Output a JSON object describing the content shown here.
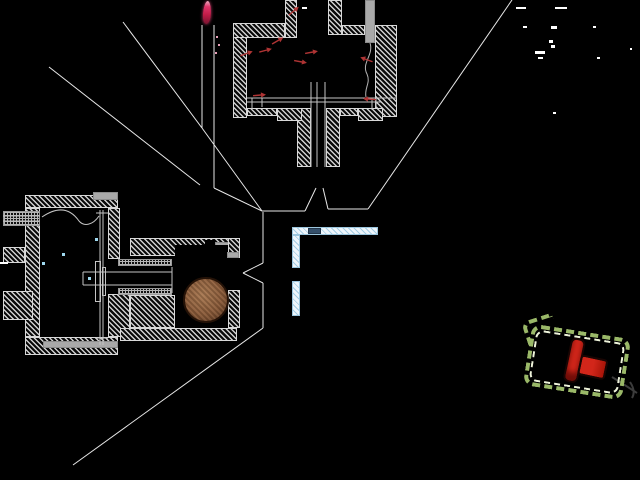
{
  "canvas": {
    "width": 640,
    "height": 480,
    "background": "#000000"
  },
  "palette": {
    "hatch_line": "#cfcfcf",
    "block_outline": "#d8d8d8",
    "gray_fill": "#a9a9a9",
    "knurl_dot": "#b5b5b5",
    "cyan_fill": "#eef6fc",
    "cyan_hatch": "#a5cde4",
    "dark_blue_block": "#35506b",
    "leader_line": "#e8e8e8",
    "detail_line": "#c4c4c4",
    "wire_line": "#b4b4b4",
    "hook_line": "#3c3c3c",
    "red_arrow": "#b03434",
    "flame_core": "#c21c48",
    "flame_glow": "#e87a9a",
    "ball_brown": "#8a5a38",
    "plug_red": "#d2261a",
    "plug_dark_red": "#a81408",
    "dash_outer_green": "#9ab868",
    "dash_inner_cream": "#eef3da",
    "speck_white": "#ffffff",
    "droplet_cyan": "#9fd8ef"
  },
  "blocks": [
    {
      "name": "chamber-left-wall",
      "style": "hatch",
      "x": 233,
      "y": 23,
      "w": 14,
      "h": 95
    },
    {
      "name": "chamber-top-wall-left",
      "style": "hatch",
      "x": 233,
      "y": 23,
      "w": 52,
      "h": 15
    },
    {
      "name": "chamber-chimney-left",
      "style": "hatch",
      "x": 285,
      "y": 0,
      "w": 12,
      "h": 38
    },
    {
      "name": "chamber-chimney-right",
      "style": "hatch",
      "x": 328,
      "y": 0,
      "w": 14,
      "h": 35
    },
    {
      "name": "chamber-top-wall-mid",
      "style": "hatch",
      "x": 342,
      "y": 25,
      "w": 23,
      "h": 10
    },
    {
      "name": "chamber-right-wall",
      "style": "hatch",
      "x": 375,
      "y": 25,
      "w": 22,
      "h": 92
    },
    {
      "name": "chamber-probe-tube",
      "style": "gray",
      "x": 365,
      "y": 0,
      "w": 10,
      "h": 43
    },
    {
      "name": "nozzle-wall-left",
      "style": "hatch",
      "x": 297,
      "y": 108,
      "w": 14,
      "h": 59
    },
    {
      "name": "nozzle-wall-right",
      "style": "hatch",
      "x": 326,
      "y": 108,
      "w": 14,
      "h": 59
    },
    {
      "name": "chamber-floor-left-a",
      "style": "hatch",
      "x": 247,
      "y": 108,
      "w": 30,
      "h": 8
    },
    {
      "name": "chamber-floor-left-b",
      "style": "hatch",
      "x": 277,
      "y": 108,
      "w": 25,
      "h": 13
    },
    {
      "name": "chamber-floor-right-a",
      "style": "hatch",
      "x": 340,
      "y": 108,
      "w": 18,
      "h": 8
    },
    {
      "name": "chamber-floor-right-b",
      "style": "hatch",
      "x": 358,
      "y": 108,
      "w": 25,
      "h": 13
    },
    {
      "name": "housing-top-wall",
      "style": "hatch",
      "x": 25,
      "y": 195,
      "w": 93,
      "h": 13
    },
    {
      "name": "housing-top-cap",
      "style": "gray",
      "x": 93,
      "y": 192,
      "w": 25,
      "h": 8
    },
    {
      "name": "housing-left-wall",
      "style": "hatch",
      "x": 25,
      "y": 208,
      "w": 15,
      "h": 129
    },
    {
      "name": "inlet-fitting",
      "style": "knurl",
      "x": 3,
      "y": 211,
      "w": 37,
      "h": 15
    },
    {
      "name": "left-flange",
      "style": "hatch",
      "x": 3,
      "y": 247,
      "w": 22,
      "h": 16
    },
    {
      "name": "lower-left-block",
      "style": "hatch",
      "x": 3,
      "y": 291,
      "w": 30,
      "h": 29
    },
    {
      "name": "housing-bottom-wall",
      "style": "hatch",
      "x": 25,
      "y": 337,
      "w": 93,
      "h": 18
    },
    {
      "name": "housing-bottom-strip",
      "style": "gray",
      "x": 43,
      "y": 341,
      "w": 75,
      "h": 7
    },
    {
      "name": "housing-right-wall-upper",
      "style": "hatch",
      "x": 108,
      "y": 208,
      "w": 12,
      "h": 51
    },
    {
      "name": "housing-mid-wall-lower",
      "style": "hatch",
      "x": 108,
      "y": 294,
      "w": 22,
      "h": 43
    },
    {
      "name": "valve-body-top",
      "style": "hatch",
      "x": 130,
      "y": 238,
      "w": 107,
      "h": 18
    },
    {
      "name": "valve-body-top-notch",
      "style": "cavity",
      "x": 205,
      "y": 240,
      "w": 10,
      "h": 9
    },
    {
      "name": "valve-body-top-cap",
      "style": "gray",
      "x": 215,
      "y": 242,
      "w": 22,
      "h": 7
    },
    {
      "name": "valve-ball-cavity",
      "style": "cavity",
      "x": 175,
      "y": 245,
      "w": 60,
      "h": 83
    },
    {
      "name": "channel-thread-top",
      "style": "knurl",
      "x": 118,
      "y": 259,
      "w": 54,
      "h": 7
    },
    {
      "name": "channel-thread-bottom",
      "style": "knurl",
      "x": 118,
      "y": 288,
      "w": 54,
      "h": 7
    },
    {
      "name": "valve-body-below-channel",
      "style": "hatch",
      "x": 130,
      "y": 295,
      "w": 45,
      "h": 33
    },
    {
      "name": "valve-right-wall-top",
      "style": "hatch",
      "x": 228,
      "y": 238,
      "w": 12,
      "h": 20
    },
    {
      "name": "valve-seat-band",
      "style": "gray",
      "x": 227,
      "y": 252,
      "w": 12,
      "h": 6
    },
    {
      "name": "valve-right-wall-bottom",
      "style": "hatch",
      "x": 228,
      "y": 290,
      "w": 12,
      "h": 38
    },
    {
      "name": "valve-body-bottom-wall",
      "style": "hatch",
      "x": 120,
      "y": 328,
      "w": 117,
      "h": 13
    },
    {
      "name": "stem-plate-large",
      "style": "plate",
      "x": 95,
      "y": 261,
      "w": 6,
      "h": 41
    },
    {
      "name": "stem-plate-small",
      "style": "plate",
      "x": 102,
      "y": 267,
      "w": 4,
      "h": 29
    },
    {
      "name": "bracket-horizontal-arm",
      "style": "cyan",
      "x": 292,
      "y": 227,
      "w": 86,
      "h": 8
    },
    {
      "name": "bracket-dark-insert",
      "style": "darkblue",
      "x": 308,
      "y": 228,
      "w": 13,
      "h": 6
    },
    {
      "name": "bracket-vertical-upper",
      "style": "cyan",
      "x": 292,
      "y": 235,
      "w": 8,
      "h": 33
    },
    {
      "name": "bracket-vertical-lower",
      "style": "cyan",
      "x": 292,
      "y": 281,
      "w": 8,
      "h": 35
    }
  ],
  "leader_lines": [
    [
      123,
      22,
      202,
      128
    ],
    [
      49,
      67,
      200,
      185
    ],
    [
      202,
      25,
      202,
      128
    ],
    [
      214,
      25,
      214,
      188
    ],
    [
      202,
      128,
      262,
      211
    ],
    [
      214,
      188,
      262,
      211
    ],
    [
      262,
      211,
      305,
      211
    ],
    [
      305,
      211,
      316,
      188
    ],
    [
      323,
      188,
      328,
      209
    ],
    [
      328,
      209,
      368,
      209
    ],
    [
      368,
      209,
      512,
      0
    ],
    [
      263,
      212,
      263,
      263
    ],
    [
      263,
      263,
      243,
      273
    ],
    [
      243,
      273,
      263,
      283
    ],
    [
      263,
      283,
      263,
      328
    ],
    [
      263,
      328,
      73,
      465
    ]
  ],
  "detail_lines": [
    [
      247,
      98,
      397,
      98
    ],
    [
      247,
      102,
      381,
      102
    ],
    [
      252,
      98,
      252,
      110
    ],
    [
      262,
      98,
      262,
      107
    ],
    [
      372,
      98,
      372,
      110
    ],
    [
      376,
      98,
      376,
      107
    ],
    [
      311,
      82,
      311,
      167
    ],
    [
      317,
      82,
      317,
      167
    ],
    [
      325,
      82,
      325,
      167
    ],
    [
      83,
      272,
      172,
      272
    ],
    [
      83,
      285,
      172,
      285
    ],
    [
      172,
      267,
      172,
      293
    ],
    [
      83,
      272,
      83,
      285
    ],
    [
      100,
      210,
      100,
      345
    ],
    [
      103,
      210,
      103,
      345
    ],
    [
      96,
      213,
      108,
      213
    ],
    [
      96,
      338,
      108,
      338
    ],
    [
      3,
      216,
      40,
      216
    ],
    [
      3,
      221,
      40,
      221
    ]
  ],
  "curves": [
    {
      "name": "fuel-line-wire",
      "d": "M42,217 C58,206 70,208 79,221 C84,227 93,225 99,216",
      "stroke": "#c4c4c4",
      "w": 1
    },
    {
      "name": "thermocouple-wire",
      "d": "M370,43 C374,55 361,63 367,74 C371,83 364,88 366,97",
      "stroke": "#b4b4b4",
      "w": 1
    },
    {
      "name": "plug-lead-wire",
      "d": "M612,377 C620,382 628,387 637,393",
      "stroke": "#3c3c3c",
      "w": 2
    },
    {
      "name": "plug-lead-hook",
      "d": "M630,382 C634,388 635,393 632,398",
      "stroke": "#3c3c3c",
      "w": 2
    }
  ],
  "particle_arrows": [
    [
      248,
      53,
      -20
    ],
    [
      267,
      50,
      -15
    ],
    [
      279,
      40,
      -30
    ],
    [
      295,
      10,
      -40
    ],
    [
      302,
      62,
      10
    ],
    [
      313,
      52,
      -10
    ],
    [
      365,
      59,
      200
    ],
    [
      261,
      95,
      -5
    ],
    [
      368,
      99,
      185
    ]
  ],
  "specks": [
    [
      516,
      7,
      10,
      2
    ],
    [
      555,
      7,
      12,
      2
    ],
    [
      523,
      26,
      4,
      2
    ],
    [
      551,
      26,
      6,
      3
    ],
    [
      549,
      40,
      4,
      3
    ],
    [
      551,
      45,
      4,
      3
    ],
    [
      535,
      51,
      10,
      3
    ],
    [
      538,
      57,
      5,
      2
    ],
    [
      593,
      26,
      3,
      2
    ],
    [
      597,
      57,
      3,
      2
    ],
    [
      630,
      48,
      2,
      2
    ],
    [
      553,
      112,
      3,
      2
    ],
    [
      302,
      7,
      5,
      2
    ],
    [
      0,
      262,
      8,
      2
    ],
    [
      216,
      36,
      2,
      2,
      "#e8a0b8"
    ],
    [
      218,
      44,
      2,
      2,
      "#e8a0b8"
    ],
    [
      215,
      52,
      2,
      2,
      "#e8a0b8"
    ],
    [
      62,
      253,
      3,
      3,
      "#9fd8ef"
    ],
    [
      88,
      277,
      3,
      3,
      "#9fd8ef"
    ],
    [
      95,
      238,
      3,
      3,
      "#9fd8ef"
    ],
    [
      42,
      262,
      3,
      3,
      "#9fd8ef"
    ]
  ],
  "components": {
    "flame": {
      "x": 203,
      "y": 1,
      "w": 8,
      "h": 23,
      "rot": 4
    },
    "ball": {
      "x": 183,
      "y": 277,
      "d": 46
    },
    "plug": {
      "x": 566,
      "y": 341,
      "w": 46,
      "h": 50,
      "rot": 12
    },
    "dash_box": {
      "x": 527,
      "y": 331,
      "w": 100,
      "h": 62,
      "rot": 9
    },
    "dash_flap": {
      "x": 524,
      "y": 317,
      "w": 32,
      "h": 24,
      "rot": -18
    }
  }
}
